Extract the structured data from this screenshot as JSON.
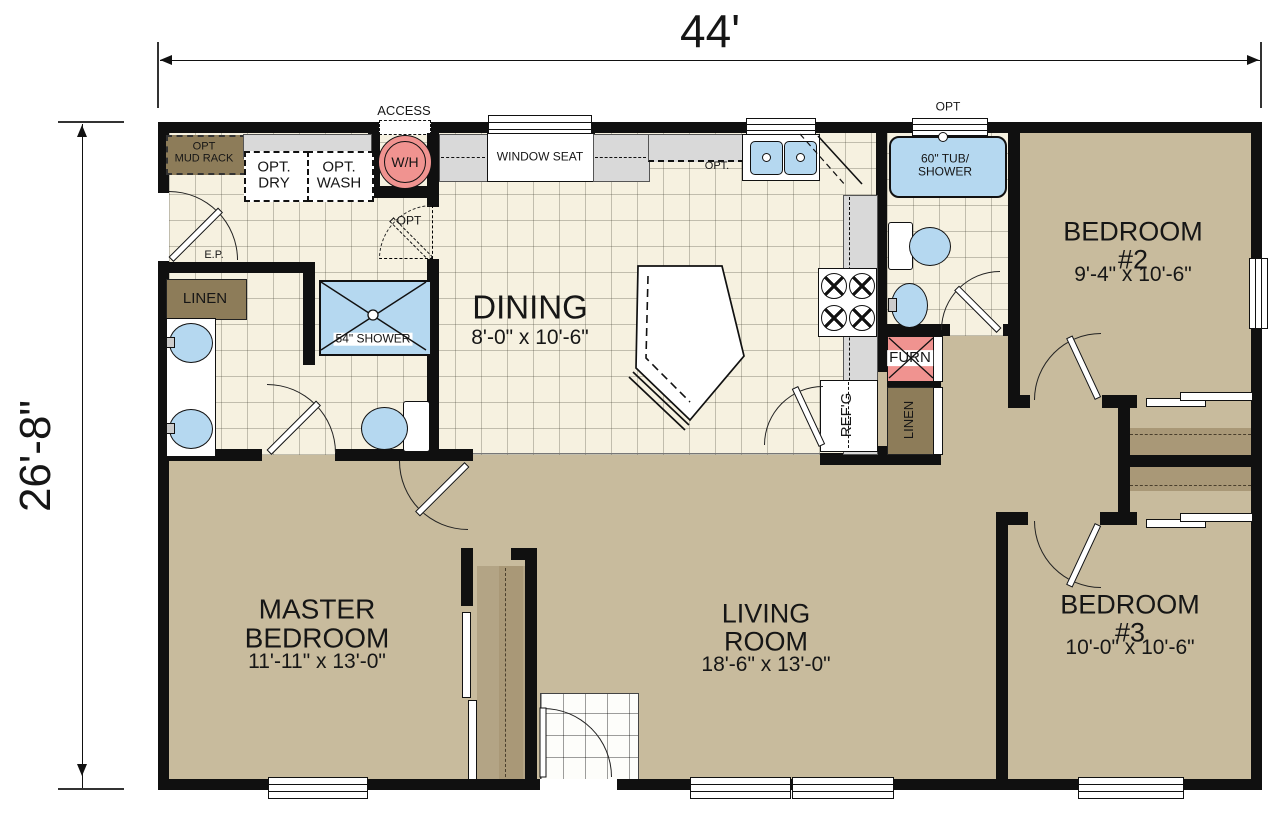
{
  "dimensions": {
    "width": "44'",
    "height": "26'-8\""
  },
  "rooms": {
    "dining": {
      "name": "DINING",
      "size": "8'-0\" x 10'-6\""
    },
    "master_bedroom": {
      "name": "MASTER\nBEDROOM",
      "size": "11'-11\" x 13'-0\""
    },
    "living_room": {
      "name": "LIVING\nROOM",
      "size": "18'-6\" x 13'-0\""
    },
    "bedroom_2": {
      "name": "BEDROOM #2",
      "size": "9'-4\" x 10'-6\""
    },
    "bedroom_3": {
      "name": "BEDROOM #3",
      "size": "10'-0\" x 10'-6\""
    }
  },
  "labels": {
    "access": "ACCESS",
    "water_heater": "W/H",
    "opt_mud_rack": "OPT\nMUD RACK",
    "opt_dryer": "OPT.\nDRY",
    "opt_washer": "OPT.\nWASH",
    "electrical_panel": "E.P.",
    "linen_master": "LINEN",
    "shower_54": "54\" SHOWER",
    "window_seat": "WINDOW SEAT",
    "opt_cabinets": "OPT.",
    "opt_door": "OPT",
    "opt_window": "OPT",
    "tub_shower": "60\" TUB/\nSHOWER",
    "furnace": "FURN",
    "refrigerator": "REF'G",
    "linen_hall": "LINEN"
  },
  "colors": {
    "wall": "#101010",
    "floor_tan": "#c8bb9d",
    "tile": "#f6f1e0",
    "fixture_blue": "#b5d8f0",
    "accent_pink": "#f09390",
    "wood_brown": "#8d7c59",
    "shelf_brown": "#a99877",
    "counter_grey": "#d9d9d9"
  }
}
